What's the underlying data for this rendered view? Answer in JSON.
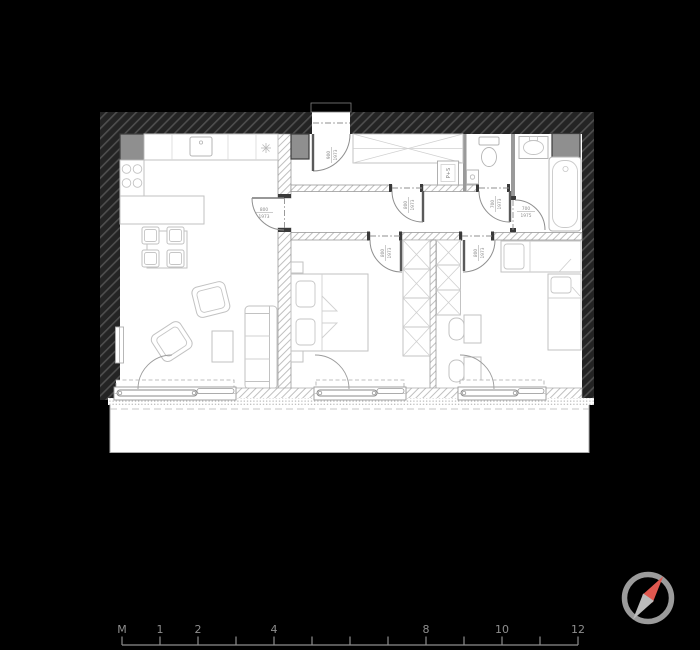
{
  "plan": {
    "type": "apartment floor plan drawing",
    "door_labels": {
      "entrance": {
        "width": "900",
        "height": "1973"
      },
      "kitchen": {
        "width": "800",
        "height": "1973"
      },
      "hall": {
        "width": "800",
        "height": "1973"
      },
      "wc": {
        "width": "700",
        "height": "1973"
      },
      "bathroom": {
        "width": "700",
        "height": "1975"
      },
      "bedroom1": {
        "width": "800",
        "height": "1973"
      },
      "bedroom2": {
        "width": "800",
        "height": "1973"
      }
    },
    "appliances": {
      "washer_dryer": "P+S"
    }
  },
  "scale_bar": {
    "unit": "M",
    "marks": {
      "m1": "1",
      "m2": "2",
      "m4": "4",
      "m8": "8",
      "m10": "10",
      "m12": "12"
    }
  },
  "colors": {
    "background": "#000000",
    "paper": "#ffffff",
    "wall_fill": "#242424",
    "wall_hatch": "#4e4e4e",
    "gray_box": "#8f8f8f",
    "furniture_line": "#c2c2c2",
    "door_line": "#8f8f8f",
    "label_text": "#8a8a8a",
    "scale_text": "#8e8e8e",
    "compass_ring": "#9b9b9b",
    "compass_north": "#e0584f",
    "compass_south": "#bcbcbc"
  }
}
